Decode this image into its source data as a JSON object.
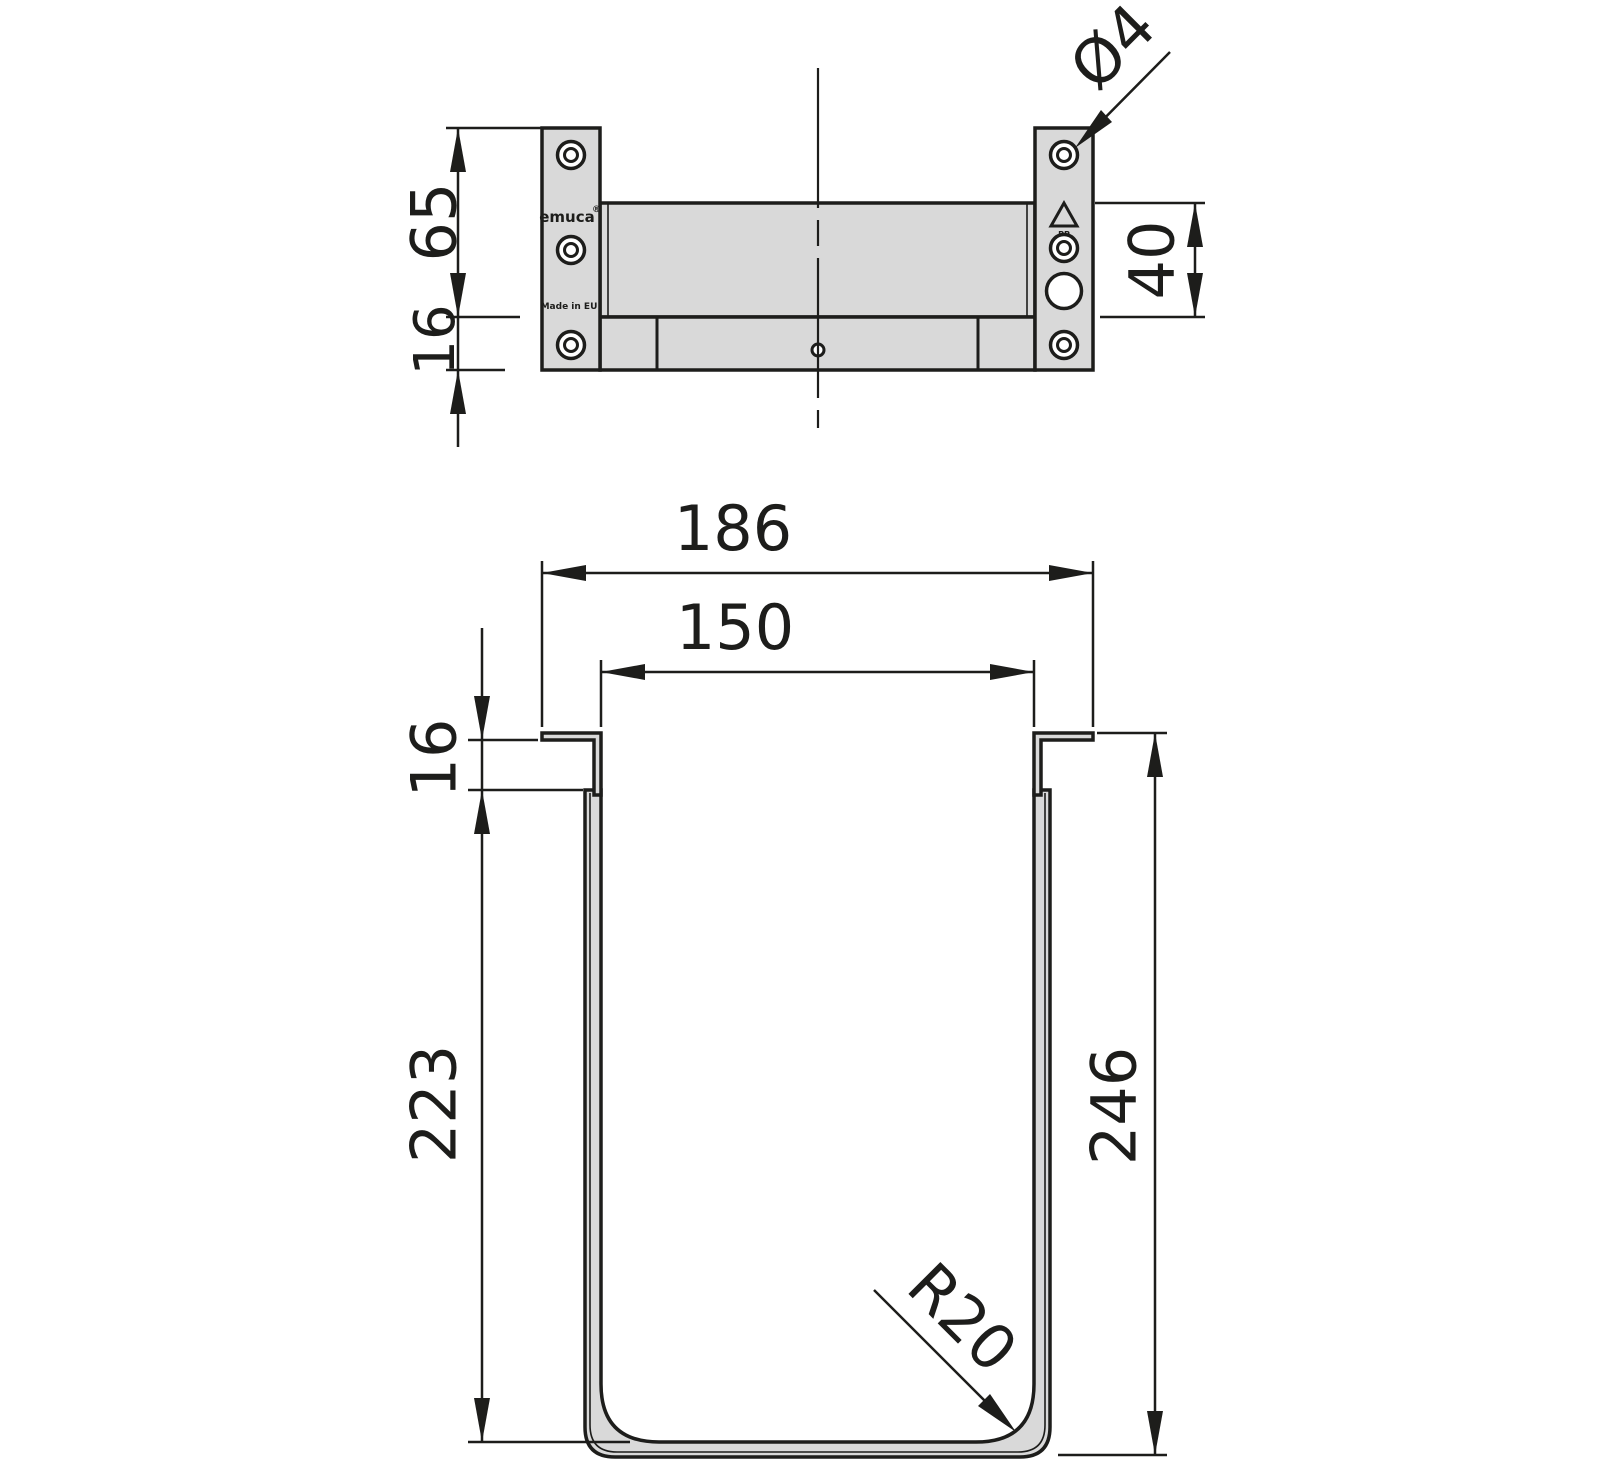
{
  "drawing": {
    "branding": {
      "logo": "emuca",
      "logo_mark": "®",
      "origin": "Made in EU",
      "material": "PP"
    },
    "top_view": {
      "name": "bracket-front-view",
      "dims": {
        "tab_height": "65",
        "rail_height": "16",
        "back_panel_height": "40",
        "hole_diameter": "Ø4"
      }
    },
    "bottom_view": {
      "name": "container-section-view",
      "dims": {
        "outer_width": "186",
        "inner_width": "150",
        "hook_depth": "16",
        "inner_depth": "223",
        "overall_depth": "246",
        "corner_radius": "R20"
      }
    },
    "colors": {
      "line": "#1d1d1b",
      "fill": "#d9d9d9",
      "background": "#ffffff"
    }
  }
}
